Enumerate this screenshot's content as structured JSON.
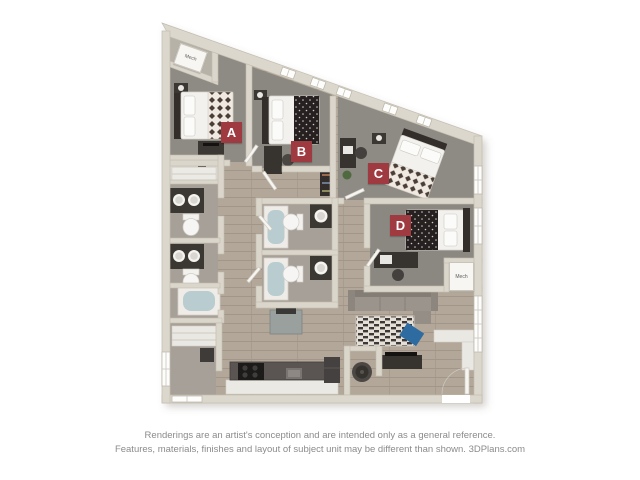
{
  "floorplan": {
    "unit_labels": [
      {
        "label": "A"
      },
      {
        "label": "B"
      },
      {
        "label": "C"
      },
      {
        "label": "D"
      }
    ],
    "mech_labels": [
      "Mech",
      "Mech"
    ],
    "colors": {
      "bedroom_label_bg": "#9e3a40",
      "bedroom_label_text": "#ffffff",
      "wall": "#dbd6cb",
      "carpet_floor": "#8e8a84",
      "wood_floor": "#b5a898",
      "bath_floor": "#a7a098",
      "tub_water": "#b9cdd0",
      "accent_pillow_blue": "#2d6ba0",
      "dark_furniture": "#3b3733"
    }
  },
  "footer": {
    "line1": "Renderings are an artist's conception and are intended only as a general reference.",
    "line2": "Features, materials, finishes and layout of subject unit may be different than shown. 3DPlans.com"
  }
}
